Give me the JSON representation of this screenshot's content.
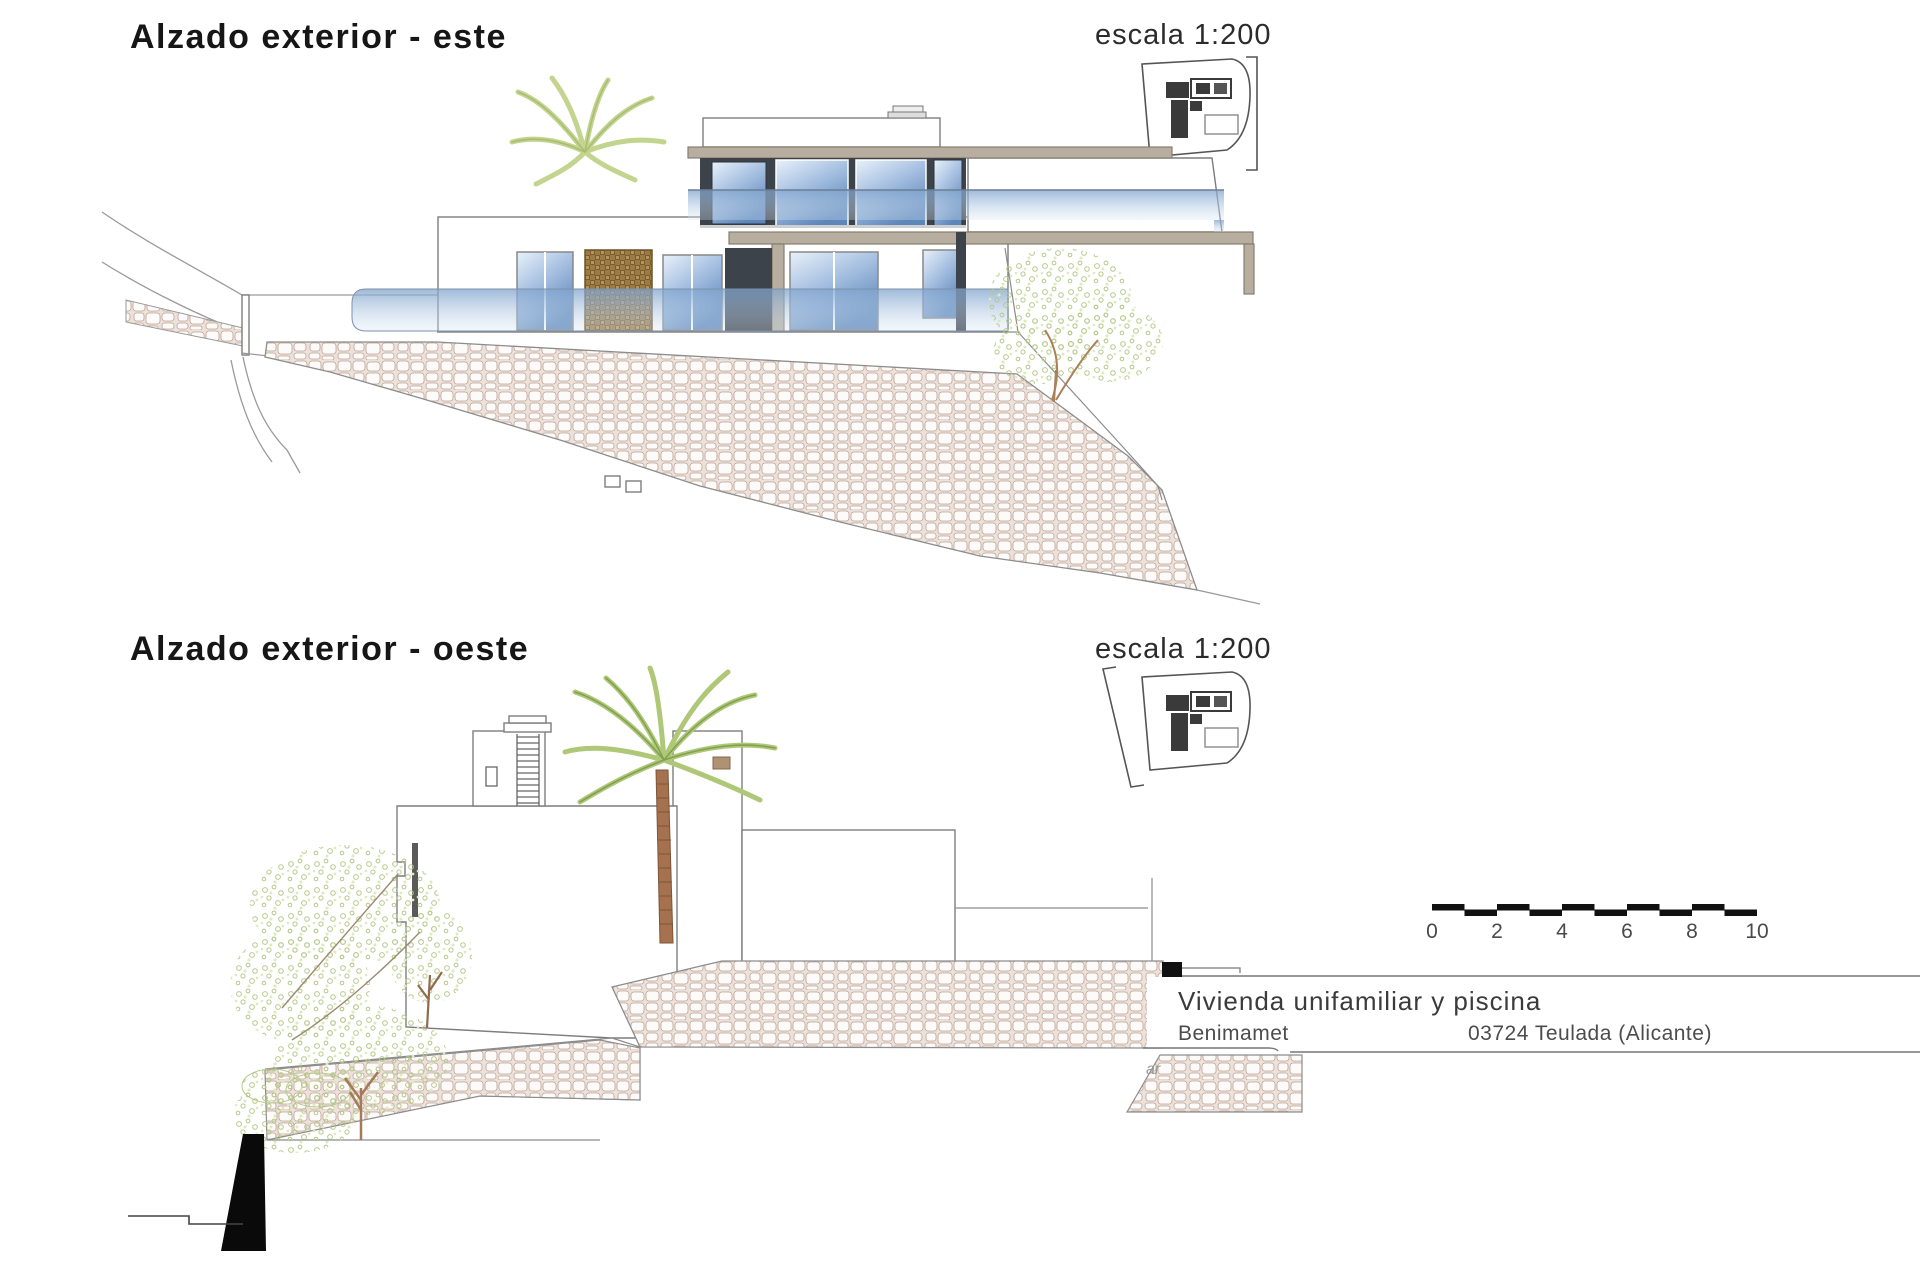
{
  "sheet": {
    "background": "#ffffff"
  },
  "top_drawing": {
    "title": "Alzado exterior - este",
    "scale_label": "escala 1:200",
    "icon": "site-plan-thumbnail-east"
  },
  "bottom_drawing": {
    "title": "Alzado exterior - oeste",
    "scale_label": "escala 1:200",
    "icon": "site-plan-thumbnail-west"
  },
  "title_block": {
    "project": "Vivienda unifamiliar y piscina",
    "municipality": "Benimamet",
    "postal_city": "03724 Teulada (Alicante)",
    "watermark_fragment": "ar"
  },
  "scale_bar": {
    "labels": [
      "0",
      "2",
      "4",
      "6",
      "8",
      "10"
    ]
  },
  "colors": {
    "glass_light": "#e8f1fa",
    "glass_dark": "#5d87bb",
    "charcoal_panel": "#3d434b",
    "concrete_slab": "#b7ae9f",
    "wicker_brown": "#9c7a44",
    "stone_outline": "#bfa394",
    "stone_mortar": "#ece2db",
    "foliage_green": "#b6c98a",
    "palm_green": "#aec878",
    "trunk_brown": "#a5714e",
    "line_gray": "#8c8c8c",
    "text_dark": "#1c1c1c"
  }
}
